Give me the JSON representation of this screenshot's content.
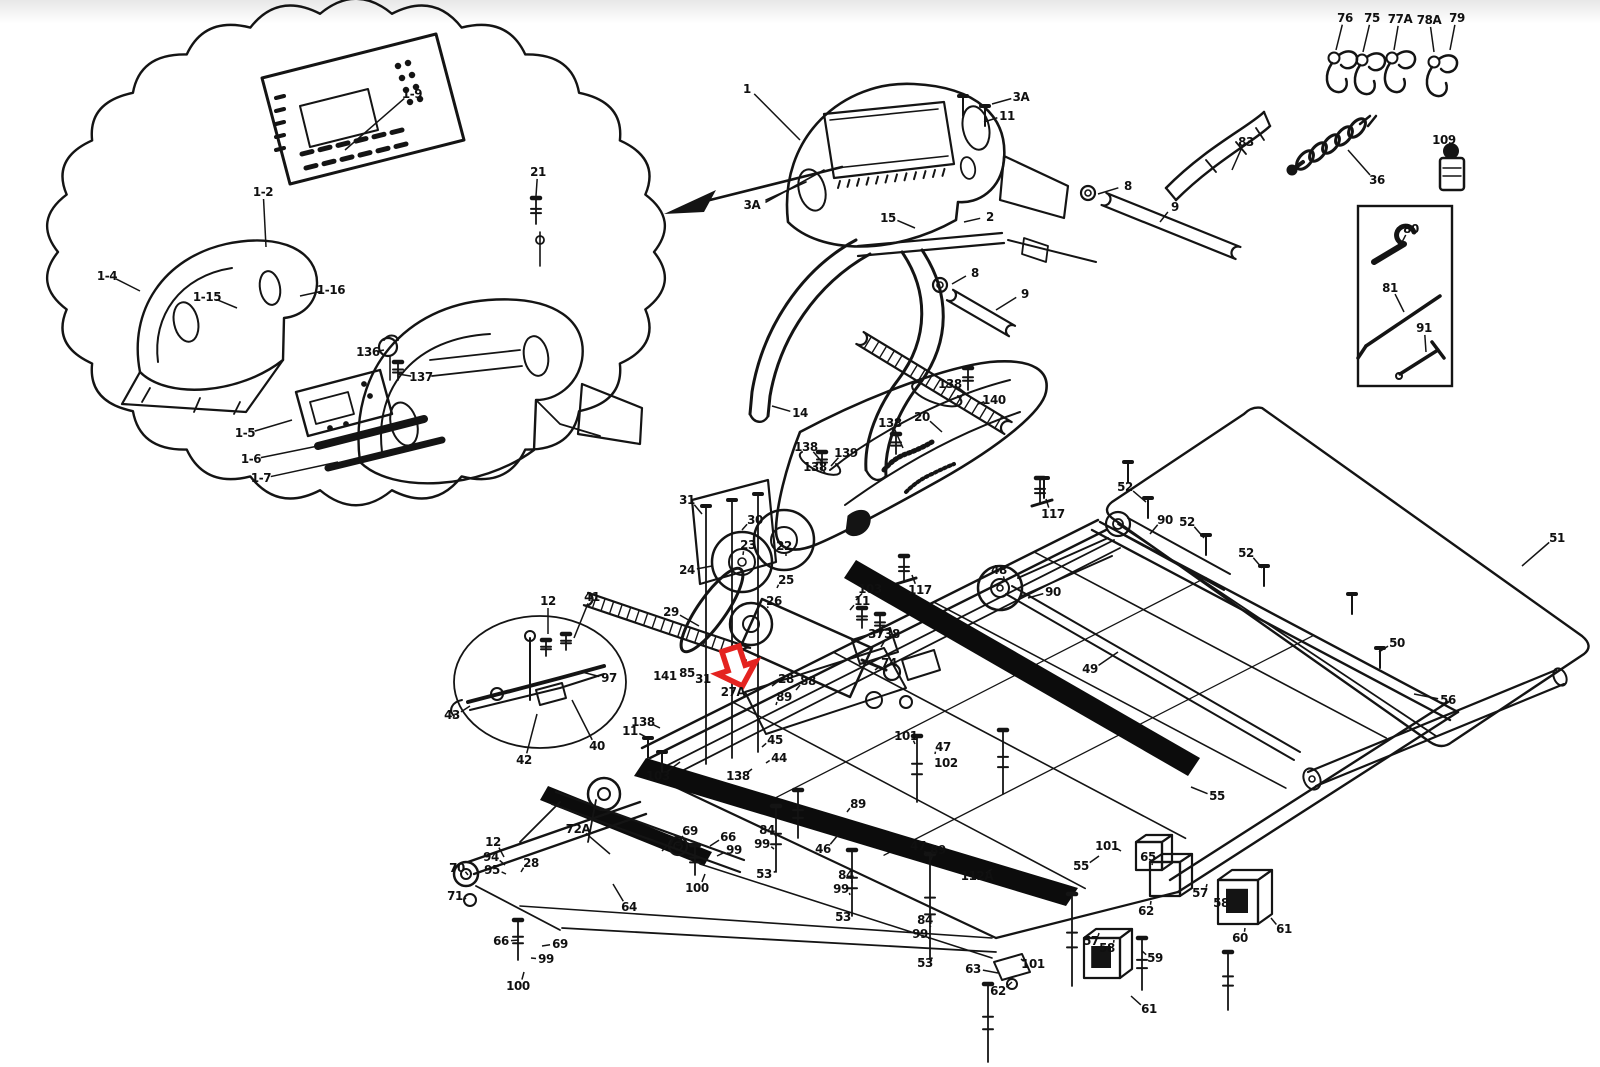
{
  "page": {
    "background": "#ffffff",
    "ink": "#141414"
  },
  "annotation": {
    "name": "red-arrow-annotation",
    "color": "#e42320"
  },
  "diagram": {
    "labels": [
      {
        "t": "1-9",
        "x": 412,
        "y": 94,
        "lx": 345,
        "ly": 150
      },
      {
        "t": "1-2",
        "x": 263,
        "y": 192,
        "lx": 266,
        "ly": 247
      },
      {
        "t": "1-4",
        "x": 107,
        "y": 276,
        "lx": 140,
        "ly": 291
      },
      {
        "t": "1-15",
        "x": 207,
        "y": 297,
        "lx": 237,
        "ly": 308
      },
      {
        "t": "1-16",
        "x": 331,
        "y": 290,
        "lx": 300,
        "ly": 296
      },
      {
        "t": "21",
        "x": 538,
        "y": 172,
        "lx": 536,
        "ly": 196
      },
      {
        "t": "136",
        "x": 368,
        "y": 352,
        "lx": 384,
        "ly": 350
      },
      {
        "t": "137",
        "x": 421,
        "y": 377,
        "lx": 398,
        "ly": 374
      },
      {
        "t": "1-5",
        "x": 245,
        "y": 433,
        "lx": 292,
        "ly": 420
      },
      {
        "t": "1-6",
        "x": 251,
        "y": 459,
        "lx": 318,
        "ly": 446
      },
      {
        "t": "1-7",
        "x": 261,
        "y": 478,
        "lx": 338,
        "ly": 462
      },
      {
        "t": "1",
        "x": 747,
        "y": 89,
        "lx": 800,
        "ly": 140
      },
      {
        "t": "3A",
        "x": 1021,
        "y": 97,
        "lx": 992,
        "ly": 104
      },
      {
        "t": "11",
        "x": 1007,
        "y": 116,
        "lx": 984,
        "ly": 122
      },
      {
        "t": "3A",
        "x": 752,
        "y": 205
      },
      {
        "t": "15",
        "x": 888,
        "y": 218,
        "lx": 915,
        "ly": 228
      },
      {
        "t": "2",
        "x": 990,
        "y": 217,
        "lx": 964,
        "ly": 222
      },
      {
        "t": "8",
        "x": 975,
        "y": 273,
        "lx": 952,
        "ly": 284
      },
      {
        "t": "9",
        "x": 1025,
        "y": 294,
        "lx": 996,
        "ly": 310
      },
      {
        "t": "14",
        "x": 800,
        "y": 413,
        "lx": 772,
        "ly": 406
      },
      {
        "t": "8",
        "x": 1128,
        "y": 186,
        "lx": 1098,
        "ly": 194
      },
      {
        "t": "9",
        "x": 1175,
        "y": 207,
        "lx": 1160,
        "ly": 222
      },
      {
        "t": "76",
        "x": 1345,
        "y": 18,
        "lx": 1336,
        "ly": 50
      },
      {
        "t": "75",
        "x": 1372,
        "y": 18,
        "lx": 1363,
        "ly": 52
      },
      {
        "t": "77A",
        "x": 1400,
        "y": 19,
        "lx": 1394,
        "ly": 50
      },
      {
        "t": "78A",
        "x": 1429,
        "y": 20,
        "lx": 1434,
        "ly": 52
      },
      {
        "t": "79",
        "x": 1457,
        "y": 18,
        "lx": 1450,
        "ly": 50
      },
      {
        "t": "83",
        "x": 1246,
        "y": 142,
        "lx": 1232,
        "ly": 170
      },
      {
        "t": "36",
        "x": 1377,
        "y": 180,
        "lx": 1348,
        "ly": 150
      },
      {
        "t": "109",
        "x": 1444,
        "y": 140,
        "lx": 1452,
        "ly": 158
      },
      {
        "t": "80",
        "x": 1411,
        "y": 229,
        "lx": 1398,
        "ly": 250
      },
      {
        "t": "81",
        "x": 1390,
        "y": 288,
        "lx": 1404,
        "ly": 312
      },
      {
        "t": "91",
        "x": 1424,
        "y": 328,
        "lx": 1426,
        "ly": 352
      },
      {
        "t": "138",
        "x": 950,
        "y": 384,
        "lx": 972,
        "ly": 398
      },
      {
        "t": "140",
        "x": 994,
        "y": 400,
        "lx": 978,
        "ly": 404
      },
      {
        "t": "20",
        "x": 922,
        "y": 417,
        "lx": 942,
        "ly": 432
      },
      {
        "t": "138",
        "x": 890,
        "y": 423,
        "lx": 903,
        "ly": 448
      },
      {
        "t": "138",
        "x": 806,
        "y": 447,
        "lx": 822,
        "ly": 462
      },
      {
        "t": "139",
        "x": 846,
        "y": 453,
        "lx": 831,
        "ly": 466
      },
      {
        "t": "138",
        "x": 815,
        "y": 467,
        "lx": 825,
        "ly": 473
      },
      {
        "t": "117",
        "x": 1053,
        "y": 514,
        "lx": 1046,
        "ly": 499
      },
      {
        "t": "117",
        "x": 920,
        "y": 590,
        "lx": 912,
        "ly": 575
      },
      {
        "t": "52",
        "x": 1125,
        "y": 487,
        "lx": 1146,
        "ly": 502
      },
      {
        "t": "90",
        "x": 1165,
        "y": 520,
        "lx": 1150,
        "ly": 534
      },
      {
        "t": "52",
        "x": 1187,
        "y": 522,
        "lx": 1204,
        "ly": 538
      },
      {
        "t": "52",
        "x": 1246,
        "y": 553,
        "lx": 1262,
        "ly": 568
      },
      {
        "t": "51",
        "x": 1557,
        "y": 538,
        "lx": 1522,
        "ly": 566
      },
      {
        "t": "50",
        "x": 1397,
        "y": 643,
        "lx": 1379,
        "ly": 652
      },
      {
        "t": "49",
        "x": 1090,
        "y": 669,
        "lx": 1118,
        "ly": 652
      },
      {
        "t": "56",
        "x": 1448,
        "y": 700,
        "lx": 1414,
        "ly": 694
      },
      {
        "t": "48",
        "x": 999,
        "y": 570,
        "lx": 1005,
        "ly": 582
      },
      {
        "t": "90",
        "x": 1053,
        "y": 592,
        "lx": 1028,
        "ly": 598
      },
      {
        "t": "31",
        "x": 687,
        "y": 500,
        "lx": 702,
        "ly": 514
      },
      {
        "t": "30",
        "x": 755,
        "y": 520,
        "lx": 742,
        "ly": 530
      },
      {
        "t": "23",
        "x": 748,
        "y": 545,
        "lx": 743,
        "ly": 555
      },
      {
        "t": "22",
        "x": 784,
        "y": 546,
        "lx": 786,
        "ly": 556
      },
      {
        "t": "24",
        "x": 687,
        "y": 570,
        "lx": 712,
        "ly": 566
      },
      {
        "t": "25",
        "x": 786,
        "y": 580,
        "lx": 777,
        "ly": 588
      },
      {
        "t": "26",
        "x": 774,
        "y": 601,
        "lx": 768,
        "ly": 608
      },
      {
        "t": "29",
        "x": 671,
        "y": 612,
        "lx": 699,
        "ly": 626
      },
      {
        "t": "103",
        "x": 870,
        "y": 589,
        "lx": 856,
        "ly": 600
      },
      {
        "t": "11",
        "x": 862,
        "y": 601,
        "lx": 850,
        "ly": 610
      },
      {
        "t": "37",
        "x": 876,
        "y": 634
      },
      {
        "t": "38",
        "x": 892,
        "y": 634,
        "lx": 881,
        "ly": 647
      },
      {
        "t": "74",
        "x": 889,
        "y": 663,
        "lx": 875,
        "ly": 670
      },
      {
        "t": "141",
        "x": 665,
        "y": 676
      },
      {
        "t": "85",
        "x": 687,
        "y": 673
      },
      {
        "t": "31",
        "x": 703,
        "y": 679
      },
      {
        "t": "27A",
        "x": 733,
        "y": 692
      },
      {
        "t": "28",
        "x": 786,
        "y": 679,
        "lx": 772,
        "ly": 686
      },
      {
        "t": "88",
        "x": 808,
        "y": 681,
        "lx": 796,
        "ly": 690
      },
      {
        "t": "89",
        "x": 784,
        "y": 697,
        "lx": 776,
        "ly": 705
      },
      {
        "t": "97",
        "x": 609,
        "y": 678,
        "lx": 582,
        "ly": 672
      },
      {
        "t": "138",
        "x": 643,
        "y": 722,
        "lx": 660,
        "ly": 728
      },
      {
        "t": "11",
        "x": 630,
        "y": 731,
        "lx": 648,
        "ly": 738
      },
      {
        "t": "103",
        "x": 658,
        "y": 776,
        "lx": 680,
        "ly": 762
      },
      {
        "t": "45",
        "x": 775,
        "y": 740,
        "lx": 762,
        "ly": 747
      },
      {
        "t": "44",
        "x": 779,
        "y": 758,
        "lx": 766,
        "ly": 763
      },
      {
        "t": "138",
        "x": 738,
        "y": 776,
        "lx": 752,
        "ly": 769
      },
      {
        "t": "12",
        "x": 548,
        "y": 601,
        "lx": 548,
        "ly": 634
      },
      {
        "t": "41",
        "x": 592,
        "y": 597,
        "lx": 574,
        "ly": 638
      },
      {
        "t": "43",
        "x": 452,
        "y": 715,
        "lx": 470,
        "ly": 706
      },
      {
        "t": "42",
        "x": 524,
        "y": 760,
        "lx": 537,
        "ly": 714
      },
      {
        "t": "40",
        "x": 597,
        "y": 746,
        "lx": 572,
        "ly": 700
      },
      {
        "t": "70",
        "x": 457,
        "y": 868,
        "lx": 468,
        "ly": 875
      },
      {
        "t": "12",
        "x": 493,
        "y": 842,
        "lx": 504,
        "ly": 857
      },
      {
        "t": "94",
        "x": 491,
        "y": 857,
        "lx": 505,
        "ly": 865
      },
      {
        "t": "95",
        "x": 492,
        "y": 870,
        "lx": 506,
        "ly": 874
      },
      {
        "t": "28",
        "x": 531,
        "y": 863,
        "lx": 521,
        "ly": 872
      },
      {
        "t": "71",
        "x": 455,
        "y": 896,
        "lx": 466,
        "ly": 899
      },
      {
        "t": "72A",
        "x": 578,
        "y": 829,
        "lx": 610,
        "ly": 854
      },
      {
        "t": "69",
        "x": 690,
        "y": 831,
        "lx": 678,
        "ly": 843
      },
      {
        "t": "73",
        "x": 675,
        "y": 842,
        "lx": 662,
        "ly": 851
      },
      {
        "t": "66",
        "x": 728,
        "y": 837,
        "lx": 710,
        "ly": 846
      },
      {
        "t": "99",
        "x": 734,
        "y": 850,
        "lx": 717,
        "ly": 856
      },
      {
        "t": "100",
        "x": 697,
        "y": 888,
        "lx": 705,
        "ly": 874
      },
      {
        "t": "64",
        "x": 629,
        "y": 907,
        "lx": 613,
        "ly": 884
      },
      {
        "t": "66",
        "x": 501,
        "y": 941,
        "lx": 519,
        "ly": 940
      },
      {
        "t": "69",
        "x": 560,
        "y": 944,
        "lx": 542,
        "ly": 946
      },
      {
        "t": "99",
        "x": 546,
        "y": 959,
        "lx": 531,
        "ly": 958
      },
      {
        "t": "100",
        "x": 518,
        "y": 986,
        "lx": 524,
        "ly": 972
      },
      {
        "t": "84",
        "x": 767,
        "y": 830,
        "lx": 776,
        "ly": 837
      },
      {
        "t": "99",
        "x": 762,
        "y": 844,
        "lx": 774,
        "ly": 849
      },
      {
        "t": "53",
        "x": 764,
        "y": 874,
        "lx": 776,
        "ly": 871
      },
      {
        "t": "46",
        "x": 823,
        "y": 849,
        "lx": 838,
        "ly": 835
      },
      {
        "t": "89",
        "x": 858,
        "y": 804,
        "lx": 847,
        "ly": 812
      },
      {
        "t": "84",
        "x": 846,
        "y": 875,
        "lx": 852,
        "ly": 883
      },
      {
        "t": "99",
        "x": 841,
        "y": 889,
        "lx": 850,
        "ly": 895
      },
      {
        "t": "53",
        "x": 843,
        "y": 917,
        "lx": 851,
        "ly": 912
      },
      {
        "t": "47",
        "x": 918,
        "y": 846,
        "lx": 927,
        "ly": 856
      },
      {
        "t": "89",
        "x": 938,
        "y": 850,
        "lx": 931,
        "ly": 860
      },
      {
        "t": "84",
        "x": 925,
        "y": 920,
        "lx": 930,
        "ly": 927
      },
      {
        "t": "99",
        "x": 920,
        "y": 934,
        "lx": 929,
        "ly": 939
      },
      {
        "t": "53",
        "x": 925,
        "y": 963,
        "lx": 931,
        "ly": 958
      },
      {
        "t": "112A",
        "x": 977,
        "y": 876,
        "lx": 992,
        "ly": 869
      },
      {
        "t": "101",
        "x": 906,
        "y": 736,
        "lx": 915,
        "ly": 744
      },
      {
        "t": "47",
        "x": 943,
        "y": 747,
        "lx": 935,
        "ly": 754
      },
      {
        "t": "102",
        "x": 946,
        "y": 763,
        "lx": 936,
        "ly": 766
      },
      {
        "t": "55",
        "x": 1081,
        "y": 866,
        "lx": 1099,
        "ly": 856
      },
      {
        "t": "55",
        "x": 1217,
        "y": 796,
        "lx": 1191,
        "ly": 787
      },
      {
        "t": "101",
        "x": 1107,
        "y": 846,
        "lx": 1121,
        "ly": 851
      },
      {
        "t": "65",
        "x": 1148,
        "y": 857,
        "lx": 1152,
        "ly": 865
      },
      {
        "t": "57",
        "x": 1200,
        "y": 893,
        "lx": 1207,
        "ly": 884
      },
      {
        "t": "58",
        "x": 1221,
        "y": 903,
        "lx": 1229,
        "ly": 894
      },
      {
        "t": "60",
        "x": 1240,
        "y": 938,
        "lx": 1245,
        "ly": 928
      },
      {
        "t": "61",
        "x": 1284,
        "y": 929,
        "lx": 1271,
        "ly": 918
      },
      {
        "t": "62",
        "x": 1146,
        "y": 911,
        "lx": 1151,
        "ly": 901
      },
      {
        "t": "57",
        "x": 1091,
        "y": 941,
        "lx": 1099,
        "ly": 933
      },
      {
        "t": "58",
        "x": 1107,
        "y": 948,
        "lx": 1114,
        "ly": 940
      },
      {
        "t": "59",
        "x": 1155,
        "y": 958,
        "lx": 1142,
        "ly": 951
      },
      {
        "t": "63",
        "x": 973,
        "y": 969,
        "lx": 998,
        "ly": 973
      },
      {
        "t": "62",
        "x": 998,
        "y": 991,
        "lx": 1012,
        "ly": 982
      },
      {
        "t": "101",
        "x": 1033,
        "y": 964,
        "lx": 1021,
        "ly": 959
      },
      {
        "t": "61",
        "x": 1149,
        "y": 1009,
        "lx": 1131,
        "ly": 996
      }
    ]
  }
}
